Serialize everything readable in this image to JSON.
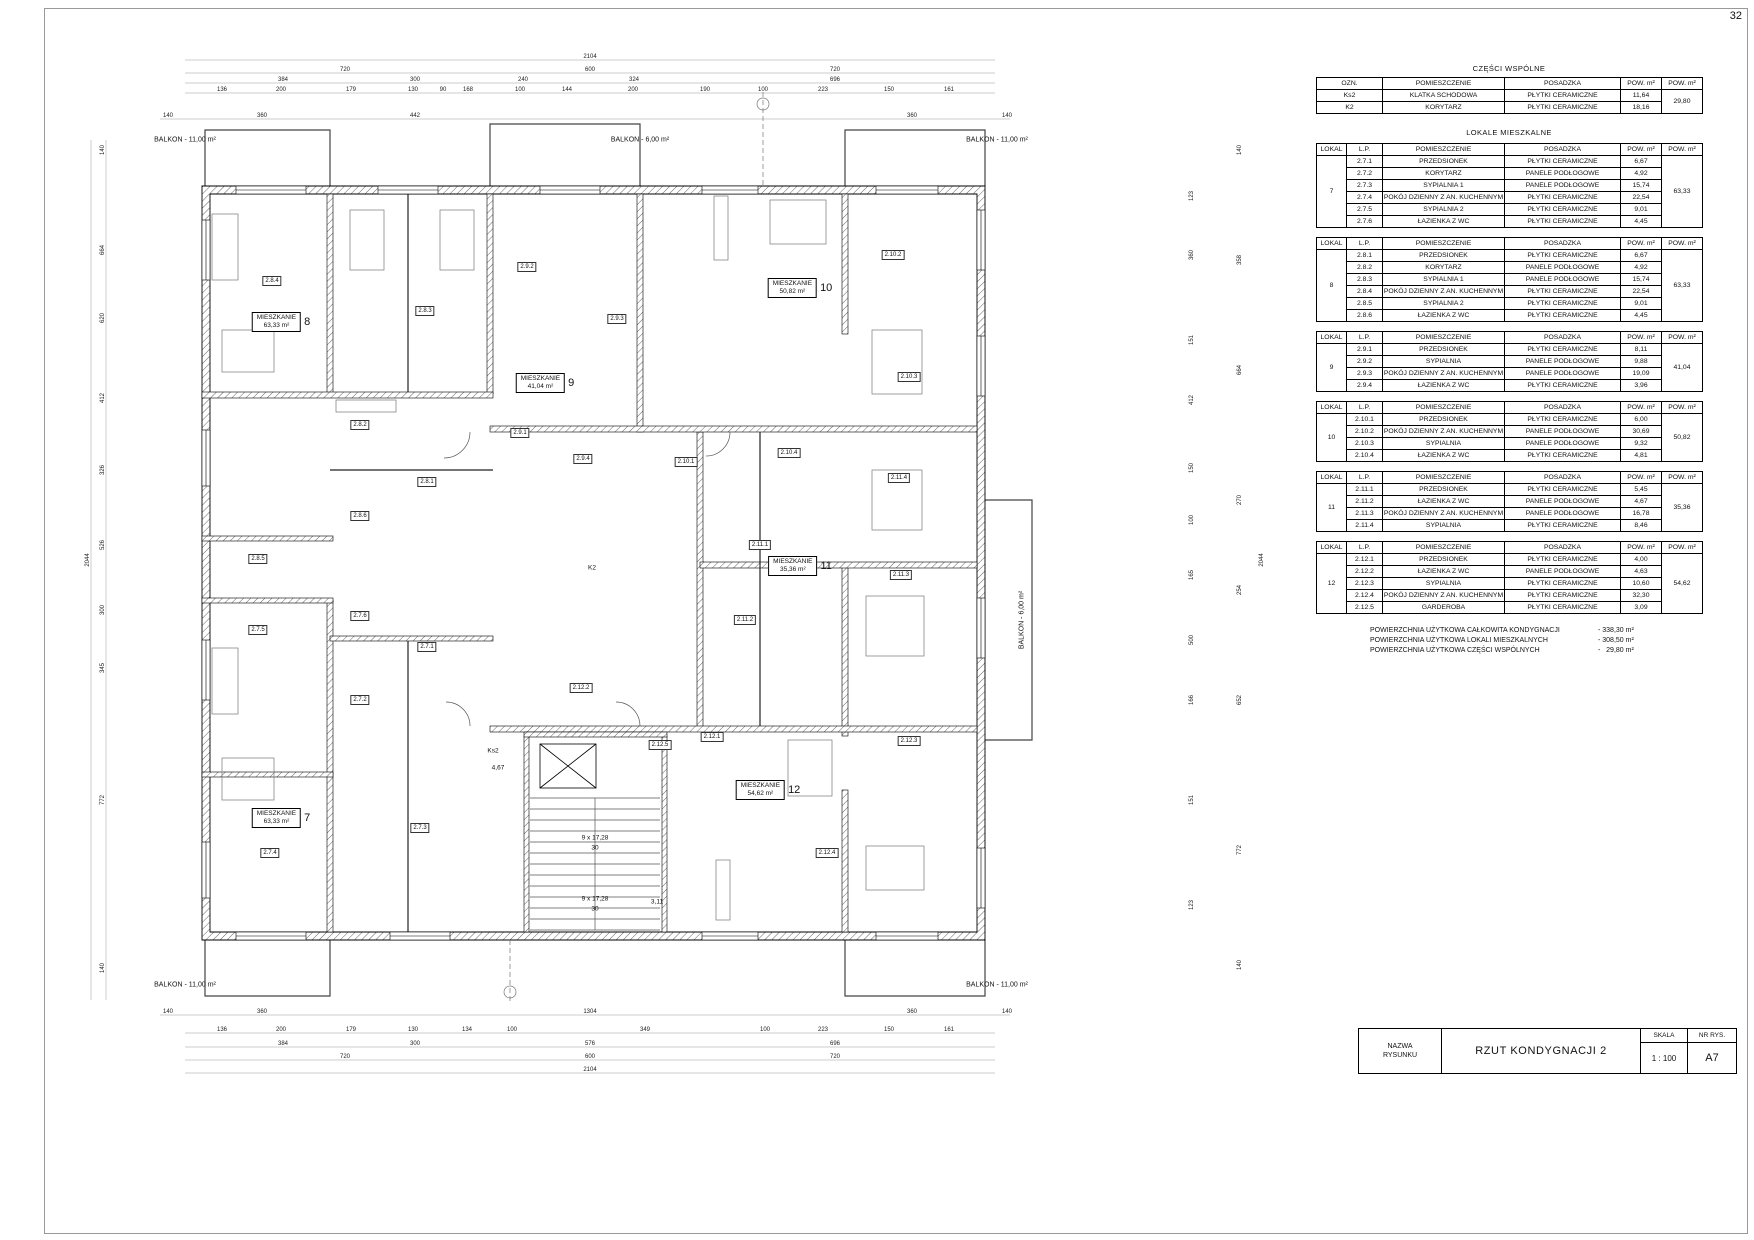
{
  "page": {
    "number": "32"
  },
  "tables": {
    "common": {
      "title": "CZĘŚCI WSPÓLNE",
      "headers": [
        "OZN.",
        "POMIESZCZENIE",
        "POSADZKA",
        "POW. m²",
        "POW. m²"
      ],
      "rows": [
        [
          "Ks2",
          "KLATKA SCHODOWA",
          "PŁYTKI CERAMICZNE",
          "11,64"
        ],
        [
          "K2",
          "KORYTARZ",
          "PŁYTKI CERAMICZNE",
          "18,16"
        ]
      ],
      "total": "29,80"
    },
    "lokale_title": "LOKALE MIESZKALNE",
    "lokale_headers": [
      "LOKAL",
      "L.P.",
      "POMIESZCZENIE",
      "POSADZKA",
      "POW. m²",
      "POW. m²"
    ],
    "lokale": [
      {
        "lokal": "7",
        "total": "63,33",
        "rows": [
          [
            "2.7.1",
            "PRZEDSIONEK",
            "PŁYTKI CERAMICZNE",
            "6,67"
          ],
          [
            "2.7.2",
            "KORYTARZ",
            "PANELE PODŁOGOWE",
            "4,92"
          ],
          [
            "2.7.3",
            "SYPIALNIA 1",
            "PANELE PODŁOGOWE",
            "15,74"
          ],
          [
            "2.7.4",
            "POKÓJ DZIENNY Z AN. KUCHENNYM",
            "PŁYTKI CERAMICZNE",
            "22,54"
          ],
          [
            "2.7.5",
            "SYPIALNIA 2",
            "PŁYTKI CERAMICZNE",
            "9,01"
          ],
          [
            "2.7.6",
            "ŁAZIENKA Z WC",
            "PŁYTKI CERAMICZNE",
            "4,45"
          ]
        ]
      },
      {
        "lokal": "8",
        "total": "63,33",
        "rows": [
          [
            "2.8.1",
            "PRZEDSIONEK",
            "PŁYTKI CERAMICZNE",
            "6,67"
          ],
          [
            "2.8.2",
            "KORYTARZ",
            "PANELE PODŁOGOWE",
            "4,92"
          ],
          [
            "2.8.3",
            "SYPIALNIA 1",
            "PANELE PODŁOGOWE",
            "15,74"
          ],
          [
            "2.8.4",
            "POKÓJ DZIENNY Z AN. KUCHENNYM",
            "PŁYTKI CERAMICZNE",
            "22,54"
          ],
          [
            "2.8.5",
            "SYPIALNIA 2",
            "PŁYTKI CERAMICZNE",
            "9,01"
          ],
          [
            "2.8.6",
            "ŁAZIENKA Z WC",
            "PŁYTKI CERAMICZNE",
            "4,45"
          ]
        ]
      },
      {
        "lokal": "9",
        "total": "41,04",
        "rows": [
          [
            "2.9.1",
            "PRZEDSIONEK",
            "PŁYTKI CERAMICZNE",
            "8,11"
          ],
          [
            "2.9.2",
            "SYPIALNIA",
            "PANELE PODŁOGOWE",
            "9,88"
          ],
          [
            "2.9.3",
            "POKÓJ DZIENNY Z AN. KUCHENNYM",
            "PANELE PODŁOGOWE",
            "19,09"
          ],
          [
            "2.9.4",
            "ŁAZIENKA Z WC",
            "PŁYTKI CERAMICZNE",
            "3,96"
          ]
        ]
      },
      {
        "lokal": "10",
        "total": "50,82",
        "rows": [
          [
            "2.10.1",
            "PRZEDSIONEK",
            "PŁYTKI CERAMICZNE",
            "6,00"
          ],
          [
            "2.10.2",
            "POKÓJ DZIENNY Z AN. KUCHENNYM",
            "PANELE PODŁOGOWE",
            "30,69"
          ],
          [
            "2.10.3",
            "SYPIALNIA",
            "PANELE PODŁOGOWE",
            "9,32"
          ],
          [
            "2.10.4",
            "ŁAZIENKA Z WC",
            "PŁYTKI CERAMICZNE",
            "4,81"
          ]
        ]
      },
      {
        "lokal": "11",
        "total": "35,36",
        "rows": [
          [
            "2.11.1",
            "PRZEDSIONEK",
            "PŁYTKI CERAMICZNE",
            "5,45"
          ],
          [
            "2.11.2",
            "ŁAZIENKA Z WC",
            "PANELE PODŁOGOWE",
            "4,67"
          ],
          [
            "2.11.3",
            "POKÓJ DZIENNY Z AN. KUCHENNYM",
            "PANELE PODŁOGOWE",
            "16,78"
          ],
          [
            "2.11.4",
            "SYPIALNIA",
            "PŁYTKI CERAMICZNE",
            "8,46"
          ]
        ]
      },
      {
        "lokal": "12",
        "total": "54,62",
        "rows": [
          [
            "2.12.1",
            "PRZEDSIONEK",
            "PŁYTKI CERAMICZNE",
            "4,00"
          ],
          [
            "2.12.2",
            "ŁAZIENKA Z WC",
            "PANELE PODŁOGOWE",
            "4,63"
          ],
          [
            "2.12.3",
            "SYPIALNIA",
            "PŁYTKI CERAMICZNE",
            "10,60"
          ],
          [
            "2.12.4",
            "POKÓJ DZIENNY Z AN. KUCHENNYM",
            "PŁYTKI CERAMICZNE",
            "32,30"
          ],
          [
            "2.12.5",
            "GARDEROBA",
            "PŁYTKI CERAMICZNE",
            "3,09"
          ]
        ]
      }
    ],
    "summary": [
      {
        "label": "POWIERZCHNIA UŻYTKOWA CAŁKOWITA KONDYGNACJI",
        "value": "- 338,30 m²"
      },
      {
        "label": "POWIERZCHNIA UŻYTKOWA LOKALI MIESZKALNYCH",
        "value": "- 308,50 m²"
      },
      {
        "label": "POWIERZCHNIA UŻYTKOWA CZĘŚCI WSPÓLNYCH",
        "value": "-   29,80 m²"
      }
    ]
  },
  "title_block": {
    "name_label": "NAZWA\nRYSUNKU",
    "drawing_title": "RZUT KONDYGNACJI 2",
    "scale_label": "SKALA",
    "scale_value": "1 : 100",
    "number_label": "NR RYS.",
    "number_value": "A7"
  },
  "plan": {
    "balconies": [
      {
        "text": "BALKON - 11,00 m²",
        "x": 185,
        "y": 140
      },
      {
        "text": "BALKON - 6,00 m²",
        "x": 640,
        "y": 140
      },
      {
        "text": "BALKON - 11,00 m²",
        "x": 997,
        "y": 140
      },
      {
        "text": "BALKON - 11,00 m²",
        "x": 185,
        "y": 985
      },
      {
        "text": "BALKON - 11,00 m²",
        "x": 997,
        "y": 985
      },
      {
        "text": "BALKON - 6,00 m²",
        "x": 1022,
        "y": 620,
        "r": -90
      }
    ],
    "apartments": [
      {
        "label": "MIESZKANIE",
        "area": "63,33 m²",
        "num": "8",
        "x": 281,
        "y": 322
      },
      {
        "label": "MIESZKANIE",
        "area": "50,82 m²",
        "num": "10",
        "x": 800,
        "y": 288
      },
      {
        "label": "MIESZKANIE",
        "area": "41,04 m²",
        "num": "9",
        "x": 545,
        "y": 383
      },
      {
        "label": "MIESZKANIE",
        "area": "35,36 m²",
        "num": "11",
        "x": 800,
        "y": 566
      },
      {
        "label": "MIESZKANIE",
        "area": "63,33 m²",
        "num": "7",
        "x": 281,
        "y": 818
      },
      {
        "label": "MIESZKANIE",
        "area": "54,62 m²",
        "num": "12",
        "x": 768,
        "y": 790
      }
    ],
    "room_tags": [
      {
        "id": "2.8.4",
        "x": 272,
        "y": 281
      },
      {
        "id": "2.9.2",
        "x": 527,
        "y": 267
      },
      {
        "id": "2.8.3",
        "x": 425,
        "y": 311
      },
      {
        "id": "2.9.3",
        "x": 617,
        "y": 319
      },
      {
        "id": "2.10.2",
        "x": 893,
        "y": 255
      },
      {
        "id": "2.10.3",
        "x": 909,
        "y": 377
      },
      {
        "id": "2.8.2",
        "x": 360,
        "y": 425
      },
      {
        "id": "2.9.1",
        "x": 520,
        "y": 433
      },
      {
        "id": "2.9.4",
        "x": 583,
        "y": 459
      },
      {
        "id": "2.10.1",
        "x": 686,
        "y": 462
      },
      {
        "id": "2.10.4",
        "x": 789,
        "y": 453
      },
      {
        "id": "2.8.1",
        "x": 427,
        "y": 482
      },
      {
        "id": "2.8.6",
        "x": 360,
        "y": 516
      },
      {
        "id": "2.8.5",
        "x": 258,
        "y": 559
      },
      {
        "id": "2.11.1",
        "x": 760,
        "y": 545
      },
      {
        "id": "2.11.4",
        "x": 899,
        "y": 478
      },
      {
        "id": "2.7.6",
        "x": 360,
        "y": 616
      },
      {
        "id": "2.7.5",
        "x": 258,
        "y": 630
      },
      {
        "id": "2.11.2",
        "x": 745,
        "y": 620
      },
      {
        "id": "2.11.3",
        "x": 901,
        "y": 575
      },
      {
        "id": "2.7.1",
        "x": 427,
        "y": 647
      },
      {
        "id": "2.12.2",
        "x": 581,
        "y": 688
      },
      {
        "id": "2.7.2",
        "x": 360,
        "y": 700
      },
      {
        "id": "2.12.3",
        "x": 909,
        "y": 741
      },
      {
        "id": "2.7.3",
        "x": 420,
        "y": 828
      },
      {
        "id": "2.7.4",
        "x": 270,
        "y": 853
      },
      {
        "id": "2.12.4",
        "x": 827,
        "y": 853
      },
      {
        "id": "2.12.1",
        "x": 712,
        "y": 737
      },
      {
        "id": "2.12.5",
        "x": 660,
        "y": 745
      }
    ],
    "texts": [
      {
        "t": "K2",
        "x": 592,
        "y": 568
      },
      {
        "t": "Ks2",
        "x": 493,
        "y": 751
      },
      {
        "t": "4,67",
        "x": 498,
        "y": 768
      },
      {
        "t": "9 x 17,28",
        "x": 595,
        "y": 838
      },
      {
        "t": "30",
        "x": 595,
        "y": 848
      },
      {
        "t": "9 x 17,28",
        "x": 595,
        "y": 899
      },
      {
        "t": "30",
        "x": 595,
        "y": 909
      },
      {
        "t": "3,11",
        "x": 657,
        "y": 902
      }
    ],
    "dims": [
      {
        "t": "2104",
        "x": 590,
        "y": 57
      },
      {
        "t": "720",
        "x": 345,
        "y": 70
      },
      {
        "t": "600",
        "x": 590,
        "y": 70
      },
      {
        "t": "720",
        "x": 835,
        "y": 70
      },
      {
        "t": "384",
        "x": 283,
        "y": 80
      },
      {
        "t": "300",
        "x": 415,
        "y": 80
      },
      {
        "t": "240",
        "x": 523,
        "y": 80
      },
      {
        "t": "324",
        "x": 634,
        "y": 80
      },
      {
        "t": "696",
        "x": 835,
        "y": 80
      },
      {
        "t": "136",
        "x": 222,
        "y": 90
      },
      {
        "t": "200",
        "x": 281,
        "y": 90
      },
      {
        "t": "179",
        "x": 351,
        "y": 90
      },
      {
        "t": "130",
        "x": 413,
        "y": 90
      },
      {
        "t": "90",
        "x": 443,
        "y": 90
      },
      {
        "t": "168",
        "x": 468,
        "y": 90
      },
      {
        "t": "100",
        "x": 520,
        "y": 90
      },
      {
        "t": "144",
        "x": 567,
        "y": 90
      },
      {
        "t": "200",
        "x": 633,
        "y": 90
      },
      {
        "t": "190",
        "x": 705,
        "y": 90
      },
      {
        "t": "100",
        "x": 763,
        "y": 90
      },
      {
        "t": "223",
        "x": 823,
        "y": 90
      },
      {
        "t": "150",
        "x": 889,
        "y": 90
      },
      {
        "t": "161",
        "x": 949,
        "y": 90
      },
      {
        "t": "140",
        "x": 168,
        "y": 116
      },
      {
        "t": "360",
        "x": 262,
        "y": 116
      },
      {
        "t": "442",
        "x": 415,
        "y": 116
      },
      {
        "t": "360",
        "x": 912,
        "y": 116
      },
      {
        "t": "140",
        "x": 1007,
        "y": 116
      },
      {
        "t": "140",
        "x": 168,
        "y": 1012
      },
      {
        "t": "360",
        "x": 262,
        "y": 1012
      },
      {
        "t": "1304",
        "x": 590,
        "y": 1012
      },
      {
        "t": "360",
        "x": 912,
        "y": 1012
      },
      {
        "t": "140",
        "x": 1007,
        "y": 1012
      },
      {
        "t": "136",
        "x": 222,
        "y": 1030
      },
      {
        "t": "200",
        "x": 281,
        "y": 1030
      },
      {
        "t": "179",
        "x": 351,
        "y": 1030
      },
      {
        "t": "130",
        "x": 413,
        "y": 1030
      },
      {
        "t": "134",
        "x": 467,
        "y": 1030
      },
      {
        "t": "100",
        "x": 512,
        "y": 1030
      },
      {
        "t": "349",
        "x": 645,
        "y": 1030
      },
      {
        "t": "100",
        "x": 765,
        "y": 1030
      },
      {
        "t": "223",
        "x": 823,
        "y": 1030
      },
      {
        "t": "150",
        "x": 889,
        "y": 1030
      },
      {
        "t": "161",
        "x": 949,
        "y": 1030
      },
      {
        "t": "384",
        "x": 283,
        "y": 1044
      },
      {
        "t": "300",
        "x": 415,
        "y": 1044
      },
      {
        "t": "576",
        "x": 590,
        "y": 1044
      },
      {
        "t": "696",
        "x": 835,
        "y": 1044
      },
      {
        "t": "720",
        "x": 345,
        "y": 1057
      },
      {
        "t": "600",
        "x": 590,
        "y": 1057
      },
      {
        "t": "720",
        "x": 835,
        "y": 1057
      },
      {
        "t": "2104",
        "x": 590,
        "y": 1070
      },
      {
        "t": "2044",
        "x": 88,
        "y": 560,
        "r": -90
      },
      {
        "t": "140",
        "x": 103,
        "y": 150,
        "r": -90
      },
      {
        "t": "664",
        "x": 103,
        "y": 250,
        "r": -90
      },
      {
        "t": "620",
        "x": 103,
        "y": 318,
        "r": -90
      },
      {
        "t": "412",
        "x": 103,
        "y": 398,
        "r": -90
      },
      {
        "t": "326",
        "x": 103,
        "y": 470,
        "r": -90
      },
      {
        "t": "526",
        "x": 103,
        "y": 545,
        "r": -90
      },
      {
        "t": "300",
        "x": 103,
        "y": 610,
        "r": -90
      },
      {
        "t": "345",
        "x": 103,
        "y": 668,
        "r": -90
      },
      {
        "t": "772",
        "x": 103,
        "y": 800,
        "r": -90
      },
      {
        "t": "140",
        "x": 103,
        "y": 968,
        "r": -90
      },
      {
        "t": "123",
        "x": 1192,
        "y": 196,
        "r": -90
      },
      {
        "t": "360",
        "x": 1192,
        "y": 255,
        "r": -90
      },
      {
        "t": "151",
        "x": 1192,
        "y": 340,
        "r": -90
      },
      {
        "t": "412",
        "x": 1192,
        "y": 400,
        "r": -90
      },
      {
        "t": "150",
        "x": 1192,
        "y": 468,
        "r": -90
      },
      {
        "t": "100",
        "x": 1192,
        "y": 520,
        "r": -90
      },
      {
        "t": "165",
        "x": 1192,
        "y": 575,
        "r": -90
      },
      {
        "t": "500",
        "x": 1192,
        "y": 640,
        "r": -90
      },
      {
        "t": "166",
        "x": 1192,
        "y": 700,
        "r": -90
      },
      {
        "t": "151",
        "x": 1192,
        "y": 800,
        "r": -90
      },
      {
        "t": "123",
        "x": 1192,
        "y": 905,
        "r": -90
      },
      {
        "t": "140",
        "x": 1240,
        "y": 150,
        "r": -90
      },
      {
        "t": "358",
        "x": 1240,
        "y": 260,
        "r": -90
      },
      {
        "t": "664",
        "x": 1240,
        "y": 370,
        "r": -90
      },
      {
        "t": "270",
        "x": 1240,
        "y": 500,
        "r": -90
      },
      {
        "t": "254",
        "x": 1240,
        "y": 590,
        "r": -90
      },
      {
        "t": "652",
        "x": 1240,
        "y": 700,
        "r": -90
      },
      {
        "t": "772",
        "x": 1240,
        "y": 850,
        "r": -90
      },
      {
        "t": "140",
        "x": 1240,
        "y": 965,
        "r": -90
      },
      {
        "t": "2044",
        "x": 1262,
        "y": 560,
        "r": -90
      }
    ]
  }
}
